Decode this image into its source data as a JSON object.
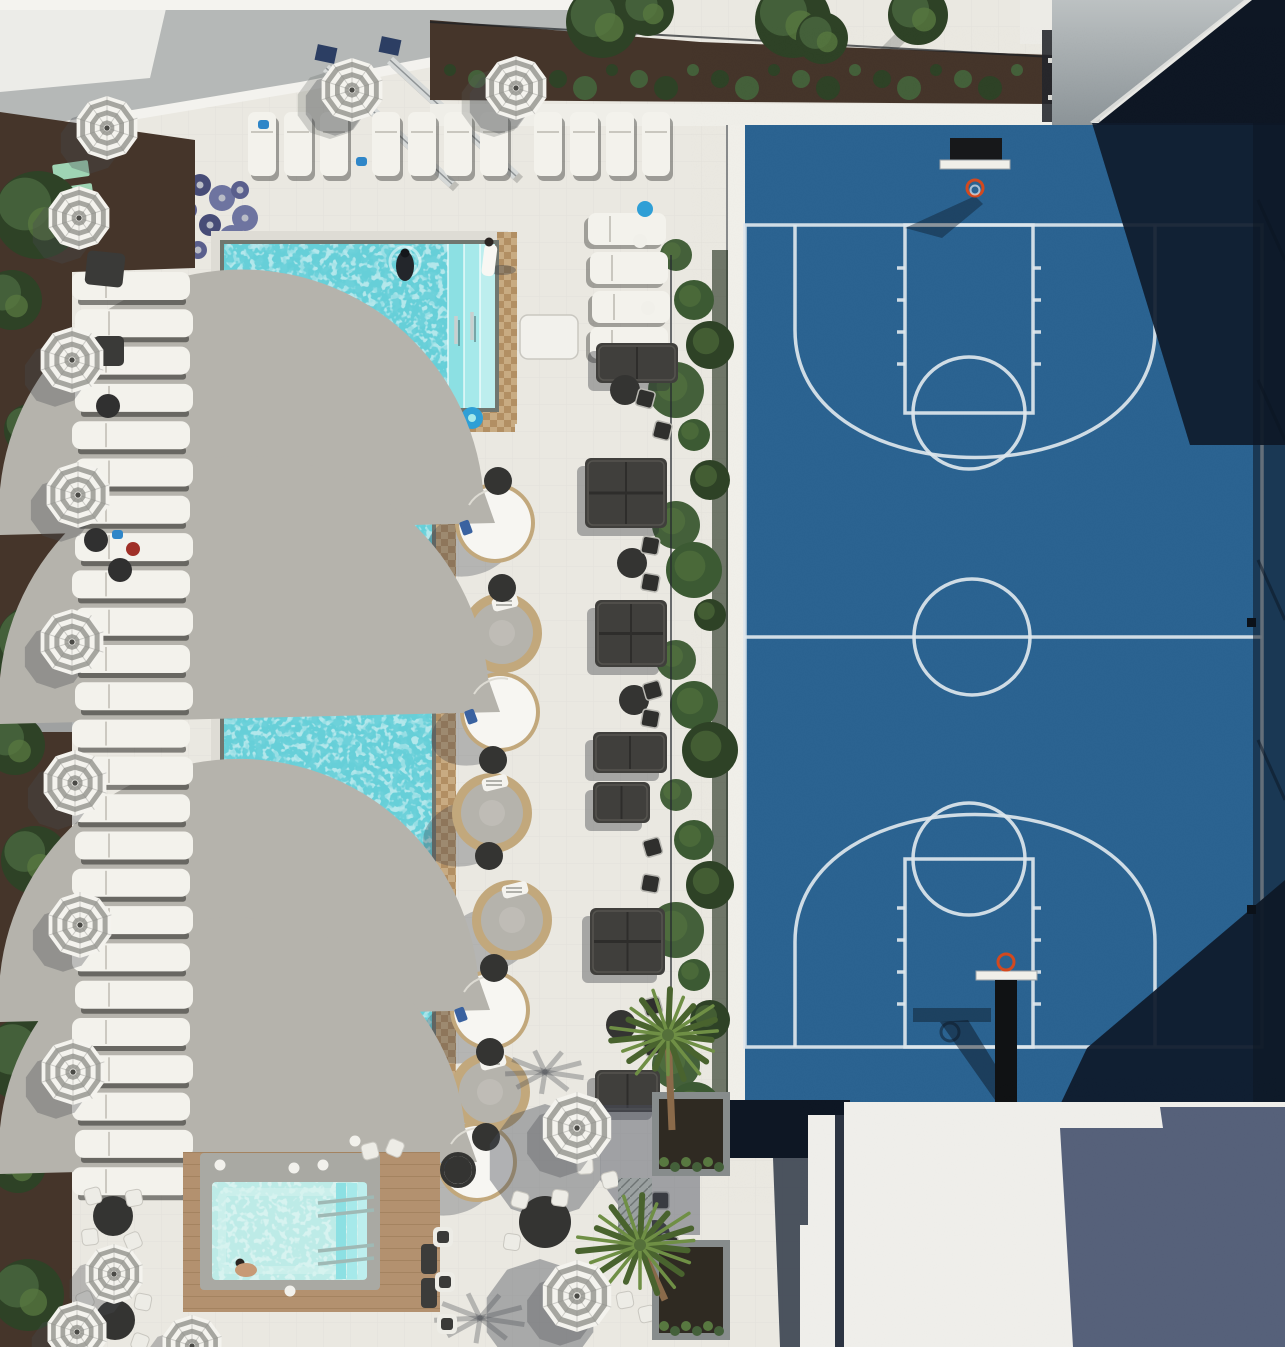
{
  "scene": {
    "kind": "aerial-photo",
    "subject": "rooftop-amenity-deck-with-pool-and-basketball-court"
  },
  "palette": {
    "deck": "#eae8e1",
    "deckLine": "#d9d7cf",
    "mulch": "#45352a",
    "treeDark": "#2e4226",
    "treeMid": "#44603a",
    "treeLight": "#587840",
    "hedge": "#3c5a33",
    "waterBase": "#66cfd8",
    "waterStep1": "#8ce0e3",
    "waterStep2": "#a6e9ea",
    "waterStep3": "#bdeeee",
    "spaWater": "#bdebe7",
    "coping": "#70766f",
    "copingOuter": "#dedcd5",
    "tanA": "#c8ab82",
    "tanB": "#b28f63",
    "courtBlue": "#2b6391",
    "courtShadow": "#0f1b2c",
    "courtDeep": "#0c1623",
    "lineWhite": "#dde6ed",
    "roofGray": "#b5b8b7",
    "roofWhite": "#efeeea",
    "wallA": "#bcc1c2",
    "wallB": "#8c9498",
    "slate": "#56617a",
    "navy": "#0e1724",
    "seam": "#2c3442",
    "wedge": "#3a4250",
    "wood": "#b3916f",
    "umbWhite": "#f4f3ee",
    "umbGray": "#a6a6a0",
    "lounger": "#f3f2ec",
    "gap": "rgba(40,40,38,0.55)",
    "sofa": "#403f3c",
    "cushline": "#55544f",
    "tableDark": "#343432",
    "chairWhite": "#edece6",
    "rattan": "#c2a87c",
    "cushion": "#b5b3ac",
    "dome": "#f7f6f2",
    "skin": "#c79a76",
    "darkSwim": "#23262b",
    "robe": "#f8f7f3",
    "chrome": "#c9cfcf",
    "palmGreen": "#6f8f45",
    "palmDark": "#49632e",
    "trunk": "#8a6a4a",
    "planter": "#878c8c",
    "soil": "#2f2a22",
    "shadow": "rgba(48,52,62,0.42)",
    "softShadow": "rgba(60,64,72,0.30)",
    "mint": "#9fd4b4"
  },
  "umbrellas": [
    {
      "x": 107,
      "y": 128,
      "r": 32
    },
    {
      "x": 79,
      "y": 218,
      "r": 32
    },
    {
      "x": 72,
      "y": 360,
      "r": 33
    },
    {
      "x": 78,
      "y": 495,
      "r": 33
    },
    {
      "x": 72,
      "y": 642,
      "r": 33
    },
    {
      "x": 75,
      "y": 783,
      "r": 33
    },
    {
      "x": 80,
      "y": 925,
      "r": 33
    },
    {
      "x": 73,
      "y": 1072,
      "r": 33
    },
    {
      "x": 114,
      "y": 1274,
      "r": 30
    },
    {
      "x": 77,
      "y": 1332,
      "r": 31
    },
    {
      "x": 352,
      "y": 90,
      "r": 32
    },
    {
      "x": 516,
      "y": 88,
      "r": 32
    },
    {
      "x": 577,
      "y": 1128,
      "r": 36
    },
    {
      "x": 577,
      "y": 1296,
      "r": 36
    },
    {
      "x": 192,
      "y": 1346,
      "r": 31
    }
  ],
  "left_loungers": {
    "x": 72,
    "w": 118,
    "h": 28,
    "y0": 272,
    "step": 37.3,
    "count": 25
  },
  "top_loungers": {
    "y": 112,
    "w": 28,
    "h": 64,
    "xs": [
      248,
      284,
      320,
      372,
      408,
      444,
      480,
      534,
      570,
      606,
      642
    ]
  },
  "ne_loungers": {
    "x": 588,
    "w": 78,
    "h": 32,
    "ys": [
      213,
      252,
      291,
      327
    ],
    "dx": [
      0,
      2,
      4,
      2
    ]
  },
  "daybeds": [
    {
      "t": "dome",
      "x": 495,
      "y": 523
    },
    {
      "t": "open",
      "x": 502,
      "y": 633
    },
    {
      "t": "dome",
      "x": 500,
      "y": 712
    },
    {
      "t": "open",
      "x": 492,
      "y": 813
    },
    {
      "t": "open",
      "x": 512,
      "y": 920
    },
    {
      "t": "dome",
      "x": 490,
      "y": 1010
    },
    {
      "t": "open",
      "x": 490,
      "y": 1092
    },
    {
      "t": "dome",
      "x": 477,
      "y": 1162
    }
  ],
  "side_tables": [
    [
      498,
      481
    ],
    [
      502,
      588
    ],
    [
      493,
      760
    ],
    [
      489,
      856
    ],
    [
      494,
      968
    ],
    [
      490,
      1052
    ],
    [
      486,
      1137
    ],
    [
      458,
      1170
    ]
  ],
  "sofas": [
    {
      "x": 596,
      "y": 343,
      "w": 82,
      "h": 40,
      "d": false
    },
    {
      "x": 585,
      "y": 458,
      "w": 82,
      "h": 70,
      "d": true
    },
    {
      "x": 595,
      "y": 600,
      "w": 72,
      "h": 67,
      "d": true
    },
    {
      "x": 593,
      "y": 732,
      "w": 74,
      "h": 41,
      "d": false
    },
    {
      "x": 593,
      "y": 782,
      "w": 57,
      "h": 41,
      "d": false
    },
    {
      "x": 590,
      "y": 908,
      "w": 75,
      "h": 67,
      "d": true
    },
    {
      "x": 595,
      "y": 1070,
      "w": 65,
      "h": 42,
      "d": false
    }
  ],
  "bistro_chairs": [
    [
      645,
      398
    ],
    [
      662,
      430
    ],
    [
      650,
      545
    ],
    [
      650,
      582
    ],
    [
      652,
      690
    ],
    [
      650,
      718
    ],
    [
      652,
      847
    ],
    [
      650,
      883
    ],
    [
      652,
      1006
    ],
    [
      652,
      1046
    ],
    [
      660,
      1200
    ],
    [
      668,
      1243
    ]
  ],
  "bistro_tables": [
    [
      625,
      390
    ],
    [
      632,
      563
    ],
    [
      634,
      700
    ],
    [
      621,
      1025
    ],
    [
      655,
      1235
    ]
  ],
  "bottom_tables": [
    [
      113,
      1216,
      20
    ],
    [
      115,
      1320,
      20
    ],
    [
      545,
      1222,
      26
    ]
  ],
  "white_chairs": [
    [
      93,
      1196
    ],
    [
      134,
      1198
    ],
    [
      90,
      1237
    ],
    [
      133,
      1241
    ],
    [
      85,
      1300
    ],
    [
      143,
      1302
    ],
    [
      88,
      1340
    ],
    [
      140,
      1342
    ],
    [
      520,
      1200
    ],
    [
      560,
      1198
    ],
    [
      512,
      1242
    ],
    [
      585,
      1166
    ],
    [
      610,
      1180
    ],
    [
      625,
      1300
    ],
    [
      647,
      1314
    ],
    [
      370,
      1151
    ],
    [
      395,
      1148
    ]
  ],
  "cushion_chairs": [
    [
      443,
      1237
    ],
    [
      445,
      1282
    ],
    [
      447,
      1324
    ]
  ],
  "trees_left": [
    {
      "x": 38,
      "y": 215,
      "r": 44
    },
    {
      "x": 12,
      "y": 300,
      "r": 30
    },
    {
      "x": 30,
      "y": 430,
      "r": 26
    },
    {
      "x": 42,
      "y": 650,
      "r": 48
    },
    {
      "x": 15,
      "y": 745,
      "r": 30
    },
    {
      "x": 35,
      "y": 860,
      "r": 34
    },
    {
      "x": 25,
      "y": 1060,
      "r": 42
    },
    {
      "x": 18,
      "y": 1165,
      "r": 28
    },
    {
      "x": 28,
      "y": 1295,
      "r": 36
    }
  ],
  "trees_top": [
    {
      "x": 602,
      "y": 22,
      "r": 36
    },
    {
      "x": 648,
      "y": 10,
      "r": 26
    },
    {
      "x": 793,
      "y": 20,
      "r": 38
    },
    {
      "x": 822,
      "y": 38,
      "r": 26
    },
    {
      "x": 918,
      "y": 15,
      "r": 30
    }
  ],
  "hedge": {
    "x": [
      676,
      694,
      710
    ],
    "y0": 255,
    "step": 45,
    "count": 20
  },
  "toys": [
    [
      178,
      170
    ],
    [
      200,
      185
    ],
    [
      222,
      198
    ],
    [
      188,
      210
    ],
    [
      210,
      225
    ],
    [
      232,
      238
    ],
    [
      198,
      250
    ],
    [
      225,
      262
    ],
    [
      245,
      218
    ],
    [
      240,
      190
    ]
  ],
  "mint_pads": [
    [
      52,
      165
    ],
    [
      56,
      188
    ],
    [
      132,
      548
    ],
    [
      142,
      572
    ]
  ],
  "palms": [
    {
      "cx": 668,
      "cy": 1035,
      "r": 55,
      "tx": 672,
      "ty": 1130
    },
    {
      "cx": 640,
      "cy": 1245,
      "r": 60,
      "tx": 665,
      "ty": 1300
    }
  ],
  "planters": [
    {
      "x": 652,
      "y": 1092,
      "w": 78,
      "h": 84
    },
    {
      "x": 652,
      "y": 1240,
      "w": 78,
      "h": 100
    }
  ],
  "palm_shadows": [
    [
      545,
      1072,
      40
    ],
    [
      480,
      1318,
      46
    ]
  ],
  "people": {
    "swimmer_dark": {
      "x": 405,
      "y": 262
    },
    "swimmer_skin": {
      "x": 328,
      "y": 330
    },
    "robe": {
      "x": 489,
      "y": 244
    },
    "spa": {
      "x": 240,
      "y": 1263
    }
  },
  "accents": {
    "blue_float": [
      472,
      418,
      11
    ],
    "blue_ball": [
      645,
      209,
      8
    ],
    "blue_towels": [
      [
        258,
        120
      ],
      [
        356,
        157
      ],
      [
        112,
        530
      ]
    ],
    "red_bag": [
      133,
      549,
      7
    ]
  }
}
